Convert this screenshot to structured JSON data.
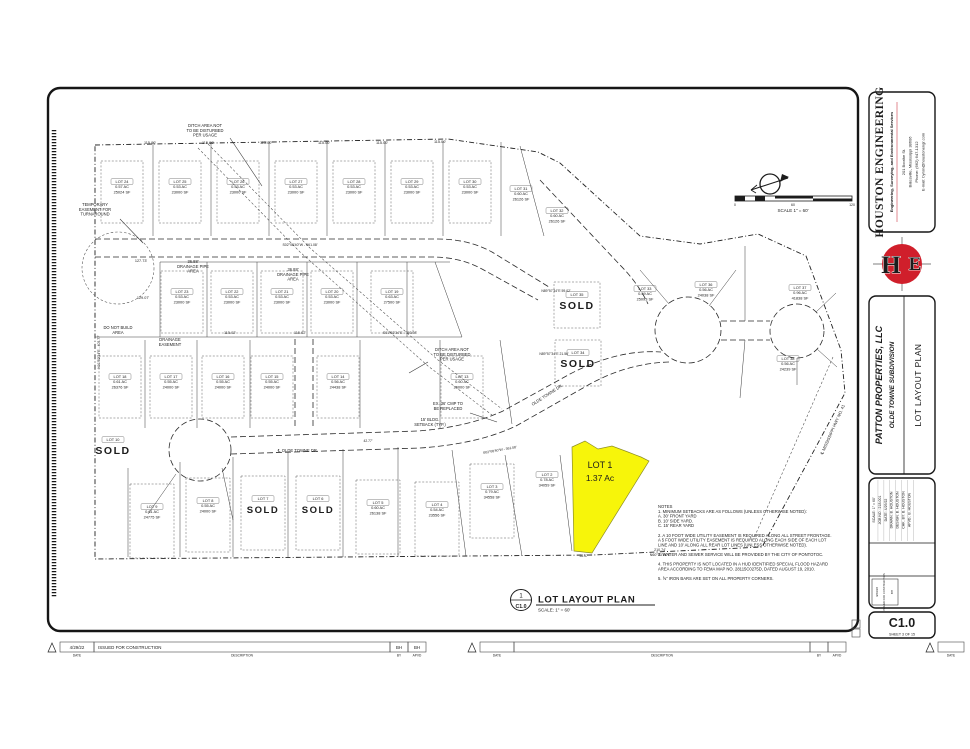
{
  "colors": {
    "ink": "#1c1c1c",
    "dim_text": "#3a3a3a",
    "highlight_yellow": "#f7f50a",
    "accent_red": "#c41723",
    "accent_navy": "#20207a"
  },
  "firm": {
    "name": "HOUSTON ENGINEERING",
    "tagline": "Engineering, Surveying, and Environmental Services",
    "addr1": "201 Boothe St.",
    "addr2": "Batesville, Mississippi 38606",
    "phone": "Phone: (662) 647-1312",
    "email": "E-mail: byron@houstonengr.com"
  },
  "project": {
    "client": "PATTON PROPERTIES, LLC",
    "name": "OLDE TOWNE SUBDIVISION",
    "sheet_title": "LOT LAYOUT PLAN"
  },
  "sheet_number": {
    "code": "C1.0",
    "caption": "SHEET   3   OF 15"
  },
  "callout": {
    "detail": "1",
    "ref": "C1.0",
    "title": "LOT LAYOUT PLAN",
    "scale": "SCALE: 1\" = 60'"
  },
  "north_scale": {
    "label": "SCALE 1\" = 60'",
    "t0": "0",
    "t60": "60",
    "t120": "120"
  },
  "info_rows": [
    {
      "l": "SCALE:",
      "v": "1\" = 60'"
    },
    {
      "l": "JOB NO.:",
      "v": "218-001"
    },
    {
      "l": "DATE:",
      "v": "4/29/22"
    },
    {
      "l": "DRAWN:",
      "v": "B. HOUSTON"
    },
    {
      "l": "DESIGN:",
      "v": "B. HOUSTON"
    },
    {
      "l": "CHK. BY:",
      "v": "B. HOUSTON"
    },
    {
      "l": "APVD.:",
      "v": "B. HOUSTON"
    }
  ],
  "revisions": {
    "entries": [
      {
        "date": "4/29/22",
        "desc": "ISSUED FOR CONSTRUCTION",
        "by": "BH",
        "apvd": "BH"
      }
    ],
    "labels": {
      "date": "DATE",
      "desc": "DESCRIPTION",
      "by": "BY",
      "apvd": "APVD"
    }
  },
  "notes": {
    "x": 658,
    "y": 508,
    "lines": [
      "NOTES",
      "1.   MINIMUM SETBACKS ARE AS FOLLOWS (UNLESS OTHERWISE NOTED):",
      "       A.  30' FRONT YARD",
      "       B.  10' SIDE YARD.",
      "       C.  15' REAR YARD",
      "",
      "2.   A 10 FOOT WIDE UTILITY EASEMENT IS REQUIRED ALONG ALL STREET FRONTAGE.",
      "       A 5 FOOT WIDE UTILITY EASEMENT IS REQUIRED ALONG EACH SIDE OF EACH LOT",
      "       LINE AND 10' ALONG ALL REAR LOT LINES (UNLESS OTHERWISE NOTED).",
      "",
      "3.   WATER AND SEWER SERVICE WILL BE PROVIDED BY THE CITY OF PONTOTOC.",
      "",
      "4.   THIS PROPERTY IS NOT LOCATED IN A HUD IDENTIFIED SPECIAL FLOOD HAZARD",
      "       AREA ACCORDING TO FEMA MAP NO. 28115C0275D, DATED AUGUST 19, 2010.",
      "",
      "5.   ⅝\" IRON BARS ARE SET ON ALL PROPERTY CORNERS."
    ]
  },
  "plat": {
    "highlight_lot": {
      "points": "572,447 585,441 598,449 612,446 628,452 641,457 649,461 592,553 574,551",
      "fill": "#f7f50a"
    },
    "lots": [
      {
        "x": 122,
        "y": 183,
        "lines": [
          "LOT 24",
          "0.57 AC",
          "25024 SF"
        ],
        "box": "std"
      },
      {
        "x": 180,
        "y": 183,
        "lines": [
          "LOT 25",
          "0.53 AC",
          "23000 SF"
        ],
        "box": "std"
      },
      {
        "x": 238,
        "y": 183,
        "lines": [
          "LOT 26",
          "0.53 AC",
          "23000 SF"
        ],
        "box": "std"
      },
      {
        "x": 296,
        "y": 183,
        "lines": [
          "LOT 27",
          "0.53 AC",
          "23000 SF"
        ],
        "box": "std"
      },
      {
        "x": 354,
        "y": 183,
        "lines": [
          "LOT 28",
          "0.53 AC",
          "23000 SF"
        ],
        "box": "std"
      },
      {
        "x": 412,
        "y": 183,
        "lines": [
          "LOT 29",
          "0.53 AC",
          "23000 SF"
        ],
        "box": "std"
      },
      {
        "x": 470,
        "y": 183,
        "lines": [
          "LOT 30",
          "0.53 AC",
          "23000 SF"
        ],
        "box": "std"
      },
      {
        "x": 521,
        "y": 190,
        "lines": [
          "LOT 31",
          "0.60 AC",
          "26126 SF"
        ]
      },
      {
        "x": 557,
        "y": 212,
        "lines": [
          "LOT 32",
          "0.60 AC",
          "26126 SF"
        ]
      },
      {
        "x": 182,
        "y": 293,
        "lines": [
          "LOT 23",
          "0.53 AC",
          "23000 SF"
        ],
        "box": "std"
      },
      {
        "x": 232,
        "y": 293,
        "lines": [
          "LOT 22",
          "0.53 AC",
          "23000 SF"
        ],
        "box": "std"
      },
      {
        "x": 282,
        "y": 293,
        "lines": [
          "LOT 21",
          "0.53 AC",
          "23000 SF"
        ],
        "box": "std"
      },
      {
        "x": 332,
        "y": 293,
        "lines": [
          "LOT 20",
          "0.53 AC",
          "23000 SF"
        ],
        "box": "std"
      },
      {
        "x": 392,
        "y": 293,
        "lines": [
          "LOT 19",
          "0.63 AC",
          "27500 SF"
        ],
        "box": "std"
      },
      {
        "x": 120,
        "y": 378,
        "lines": [
          "LOT 18",
          "0.61 AC",
          "26376 SF"
        ],
        "box": "std"
      },
      {
        "x": 171,
        "y": 378,
        "lines": [
          "LOT 17",
          "0.55 AC",
          "24000 SF"
        ],
        "box": "std"
      },
      {
        "x": 223,
        "y": 378,
        "lines": [
          "LOT 16",
          "0.55 AC",
          "24000 SF"
        ],
        "box": "std"
      },
      {
        "x": 272,
        "y": 378,
        "lines": [
          "LOT 15",
          "0.55 AC",
          "24000 SF"
        ],
        "box": "std"
      },
      {
        "x": 338,
        "y": 378,
        "lines": [
          "LOT 14",
          "0.56 AC",
          "24438 SF"
        ],
        "box": "std"
      },
      {
        "x": 462,
        "y": 378,
        "lines": [
          "LOT 13",
          "0.60 AC",
          "26000 SF"
        ],
        "box": "std"
      },
      {
        "x": 577,
        "y": 296,
        "lines": [
          "LOT 35"
        ],
        "sold": true,
        "big": true,
        "box": "std2"
      },
      {
        "x": 578,
        "y": 354,
        "lines": [
          "LOT 34"
        ],
        "sold": true,
        "big": true,
        "box": "std2"
      },
      {
        "x": 645,
        "y": 290,
        "lines": [
          "LOT 33",
          "0.59 AC",
          "25093 SF"
        ]
      },
      {
        "x": 706,
        "y": 286,
        "lines": [
          "LOT 36",
          "0.56 AC",
          "24038 SF"
        ]
      },
      {
        "x": 800,
        "y": 289,
        "lines": [
          "LOT 37",
          "0.96 AC",
          "41838 SF"
        ]
      },
      {
        "x": 788,
        "y": 360,
        "lines": [
          "LOT 38",
          "0.56 AC",
          "24239 SF"
        ]
      },
      {
        "x": 113,
        "y": 441,
        "lines": [
          "LOT 10"
        ],
        "sold": true,
        "big": true
      },
      {
        "x": 152,
        "y": 508,
        "lines": [
          "LOT 9",
          "0.61 AC",
          "24775 SF"
        ],
        "box": "tall"
      },
      {
        "x": 208,
        "y": 502,
        "lines": [
          "LOT 8",
          "0.55 AC",
          "24000 SF"
        ],
        "box": "tall"
      },
      {
        "x": 263,
        "y": 500,
        "lines": [
          "LOT 7"
        ],
        "sold": true,
        "box": "tall"
      },
      {
        "x": 318,
        "y": 500,
        "lines": [
          "LOT 6"
        ],
        "sold": true,
        "box": "tall"
      },
      {
        "x": 378,
        "y": 504,
        "lines": [
          "LOT 5",
          "0.60 AC",
          "26138 SF"
        ],
        "box": "tall"
      },
      {
        "x": 437,
        "y": 506,
        "lines": [
          "LOT 4",
          "0.54 AC",
          "23556 SF"
        ],
        "box": "tall"
      },
      {
        "x": 492,
        "y": 488,
        "lines": [
          "LOT 3",
          "0.79 AC",
          "34558 SF"
        ],
        "box": "tall"
      },
      {
        "x": 547,
        "y": 476,
        "lines": [
          "LOT 2",
          "0.78 AC",
          "34059 SF"
        ]
      },
      {
        "x": 600,
        "y": 468,
        "lines": [
          "LOT 1",
          "1.37 Ac"
        ],
        "special": true
      }
    ],
    "dims": [
      {
        "t": "115.00'",
        "x": 150,
        "y": 144
      },
      {
        "t": "115.00'",
        "x": 208,
        "y": 144
      },
      {
        "t": "115.00'",
        "x": 266,
        "y": 144
      },
      {
        "t": "115.00'",
        "x": 324,
        "y": 144
      },
      {
        "t": "115.00'",
        "x": 382,
        "y": 144
      },
      {
        "t": "115.00'",
        "x": 440,
        "y": 143
      },
      {
        "t": "S02°08'40\"W - 561.08'",
        "x": 300,
        "y": 246,
        "fs": 3.5
      },
      {
        "t": "S01°52'34\"E - 793.98'",
        "x": 400,
        "y": 334,
        "fs": 3.5
      },
      {
        "t": "115.02'",
        "x": 230,
        "y": 334
      },
      {
        "t": "115.02'",
        "x": 300,
        "y": 334
      },
      {
        "t": "127.73'",
        "x": 141,
        "y": 262
      },
      {
        "t": "129.07'",
        "x": 143,
        "y": 299
      },
      {
        "t": "N89°57'34\"E  59.02'",
        "x": 556,
        "y": 292,
        "fs": 3.4
      },
      {
        "t": "N89°57'34\"E  21.56'",
        "x": 554,
        "y": 355,
        "fs": 3.4
      },
      {
        "t": "210.74'",
        "x": 660,
        "y": 551,
        "fs": 3.6
      },
      {
        "t": "N60°03'14\"E",
        "x": 660,
        "y": 556,
        "fs": 3.6
      },
      {
        "t": "58.57'",
        "x": 584,
        "y": 557,
        "fs": 3.3
      },
      {
        "t": "S02°08'40\"W - 361.08'",
        "x": 500,
        "y": 451,
        "fs": 3.4,
        "r": -10
      },
      {
        "t": "℄  OLDE TOWNE DR.",
        "x": 298,
        "y": 452,
        "fs": 4.2,
        "ink": true
      },
      {
        "t": "OLDE TOWNE DR.",
        "x": 548,
        "y": 396,
        "fs": 4.2,
        "r": -33,
        "ink": true
      },
      {
        "t": "℄  MISSISSIPPI HWY NO. 41",
        "x": 834,
        "y": 430,
        "fs": 4.2,
        "r": -66,
        "ink": true
      },
      {
        "t": "42.77'",
        "x": 368,
        "y": 442,
        "fs": 3.3
      },
      {
        "t": "N01°52'34\"E - 405.77'",
        "x": 100,
        "y": 352,
        "fs": 3.4,
        "r": -90
      }
    ],
    "annotations": [
      {
        "x": 205,
        "y": 127,
        "lines": [
          "DITCH AREA NOT",
          "TO BE DISTURBED",
          "PER USAGE"
        ],
        "leader": [
          230,
          138,
          262,
          186
        ]
      },
      {
        "x": 95,
        "y": 206,
        "lines": [
          "TEMPORARY",
          "EASEMENT FOR",
          "TURNAROUND"
        ],
        "leader": [
          120,
          219,
          143,
          243
        ]
      },
      {
        "x": 452,
        "y": 351,
        "lines": [
          "DITCH AREA NOT",
          "TO BE DISTURBED",
          "PER USAGE"
        ],
        "leader": [
          428,
          362,
          409,
          373
        ]
      },
      {
        "x": 448,
        "y": 405,
        "lines": [
          "EX. 36' CMP TO",
          "BE REPLACED"
        ],
        "leader": [
          470,
          413,
          497,
          422
        ]
      },
      {
        "x": 118,
        "y": 329,
        "lines": [
          "DO NOT BUILD",
          "AREA"
        ]
      },
      {
        "x": 170,
        "y": 341,
        "lines": [
          "DRAINAGE",
          "EASEMENT"
        ]
      },
      {
        "x": 193,
        "y": 263,
        "lines": [
          "36.88'",
          "DRAINAGE PIPE",
          "AREA"
        ]
      },
      {
        "x": 293,
        "y": 271,
        "lines": [
          "36.88'",
          "DRAINAGE PIPE",
          "AREA"
        ]
      },
      {
        "x": 430,
        "y": 421,
        "lines": [
          "15' BLDG.",
          "SETBACK (TYP.)"
        ]
      }
    ]
  }
}
